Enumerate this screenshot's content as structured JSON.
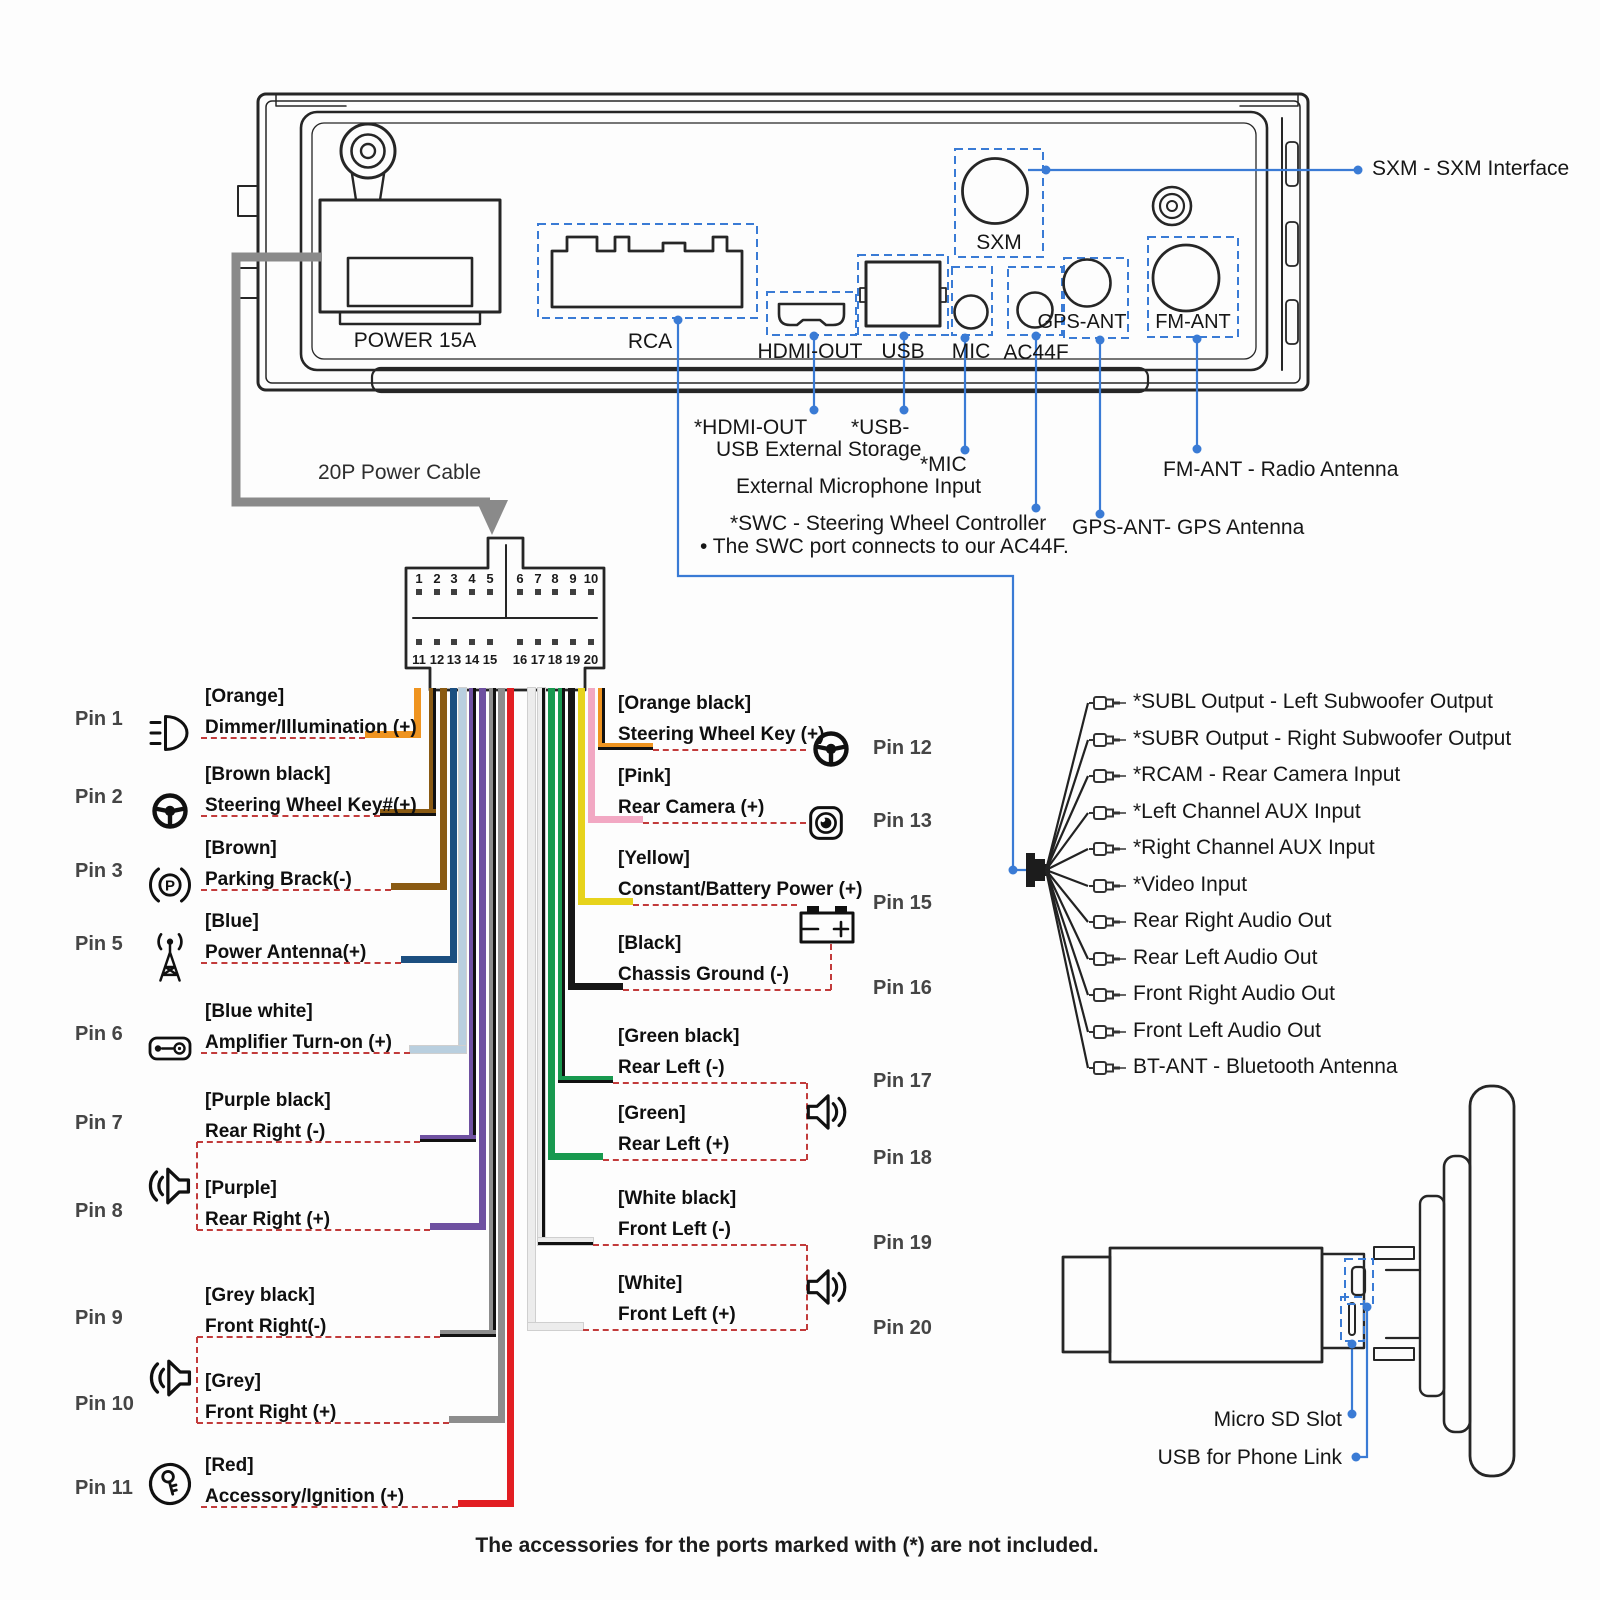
{
  "colors": {
    "callout_blue": "#3a7bd5",
    "dashed_red": "#c23b3b",
    "outline_dark": "#262626"
  },
  "panel": {
    "power_label": "POWER 15A",
    "rca_label": "RCA",
    "hdmi_label": "HDMI-OUT",
    "usb_label": "USB",
    "mic_label": "MIC",
    "ac44f_label": "AC44F",
    "gps_label": "GPS-ANT",
    "fm_label": "FM-ANT",
    "sxm_label": "SXM"
  },
  "callouts": {
    "sxm": "SXM - SXM Interface",
    "hdmi": "*HDMI-OUT",
    "usb": "*USB-",
    "usb_sub": "USB External Storage",
    "mic": "*MIC",
    "mic_sub": "External Microphone Input",
    "swc": "*SWC - Steering Wheel Controller",
    "swc_sub": "• The SWC port connects to our AC44F.",
    "gps": "GPS-ANT- GPS Antenna",
    "fm": "FM-ANT - Radio Antenna"
  },
  "power_cable": {
    "label": "20P Power Cable",
    "pins_top": [
      "1",
      "2",
      "3",
      "4",
      "5",
      "6",
      "7",
      "8",
      "9",
      "10"
    ],
    "pins_bottom": [
      "11",
      "12",
      "13",
      "14",
      "15",
      "16",
      "17",
      "18",
      "19",
      "20"
    ]
  },
  "pins_left": [
    {
      "pin": "Pin 1",
      "color": "[Orange]",
      "function": "Dimmer/Illumination (+)",
      "icon": "headlight-icon",
      "wire": "#ef9420",
      "stripe": null
    },
    {
      "pin": "Pin 2",
      "color": "[Brown black]",
      "function": "Steering Wheel Key#(+)",
      "icon": "steering-wheel-icon",
      "wire": "#8a5a12",
      "stripe": "#111111"
    },
    {
      "pin": "Pin 3",
      "color": "[Brown]",
      "function": "Parking Brack(-)",
      "icon": "parking-brake-icon",
      "wire": "#8a5a12",
      "stripe": null
    },
    {
      "pin": "Pin 5",
      "color": "[Blue]",
      "function": "Power Antenna(+)",
      "icon": "antenna-icon",
      "wire": "#1c4f80",
      "stripe": null
    },
    {
      "pin": "Pin 6",
      "color": "[Blue white]",
      "function": "Amplifier Turn-on (+)",
      "icon": "amplifier-icon",
      "wire": "#b9cfdf",
      "stripe": null
    },
    {
      "pin": "Pin 7",
      "color": "[Purple black]",
      "function": "Rear Right (-)",
      "icon": null,
      "wire": "#6f51a1",
      "stripe": "#111111"
    },
    {
      "pin": "Pin 8",
      "color": "[Purple]",
      "function": "Rear Right (+)",
      "icon": "speaker-icon",
      "wire": "#6f51a1",
      "stripe": null
    },
    {
      "pin": "Pin 9",
      "color": "[Grey black]",
      "function": "Front Right(-)",
      "icon": null,
      "wire": "#8d8d8d",
      "stripe": "#111111"
    },
    {
      "pin": "Pin 10",
      "color": "[Grey]",
      "function": "Front Right (+)",
      "icon": "speaker-icon",
      "wire": "#8d8d8d",
      "stripe": null
    },
    {
      "pin": "Pin 11",
      "color": "[Red]",
      "function": "Accessory/Ignition (+)",
      "icon": "ignition-key-icon",
      "wire": "#e21e22",
      "stripe": null
    }
  ],
  "pins_right": [
    {
      "pin": "Pin 12",
      "color": "[Orange black]",
      "function": "Steering Wheel Key (+)",
      "icon": "steering-wheel-icon",
      "wire": "#ef9420",
      "stripe": "#111111"
    },
    {
      "pin": "Pin 13",
      "color": "[Pink]",
      "function": "Rear Camera (+)",
      "icon": "camera-icon",
      "wire": "#f2a8c3",
      "stripe": null
    },
    {
      "pin": "Pin 15",
      "color": "[Yellow]",
      "function": "Constant/Battery Power (+)",
      "icon": "battery-icon",
      "wire": "#e7d31c",
      "stripe": null
    },
    {
      "pin": "Pin 16",
      "color": "[Black]",
      "function": "Chassis Ground (-)",
      "icon": null,
      "wire": "#161616",
      "stripe": null
    },
    {
      "pin": "Pin 17",
      "color": "[Green black]",
      "function": "Rear Left (-)",
      "icon": null,
      "wire": "#18994f",
      "stripe": "#111111"
    },
    {
      "pin": "Pin 18",
      "color": "[Green]",
      "function": "Rear Left (+)",
      "icon": "speaker-icon",
      "wire": "#18994f",
      "stripe": null
    },
    {
      "pin": "Pin 19",
      "color": "[White black]",
      "function": "Front Left (-)",
      "icon": null,
      "wire": "#ececec",
      "stripe": "#111111"
    },
    {
      "pin": "Pin 20",
      "color": "[White]",
      "function": "Front Left (+)",
      "icon": "speaker-icon",
      "wire": "#ececec",
      "stripe": null
    }
  ],
  "rca_outputs": [
    "*SUBL Output - Left Subwoofer Output",
    "*SUBR Output - Right Subwoofer Output",
    "*RCAM - Rear Camera Input",
    "*Left Channel AUX Input",
    "*Right Channel AUX Input",
    "*Video Input",
    "Rear Right Audio Out",
    "Rear Left Audio Out",
    "Front Right Audio Out",
    "Front Left Audio Out",
    "BT-ANT - Bluetooth Antenna"
  ],
  "bottom_right": {
    "micro_sd": "Micro SD Slot",
    "usb_phone": "USB for Phone Link"
  },
  "note": "The accessories for the ports marked with (*) are not included."
}
